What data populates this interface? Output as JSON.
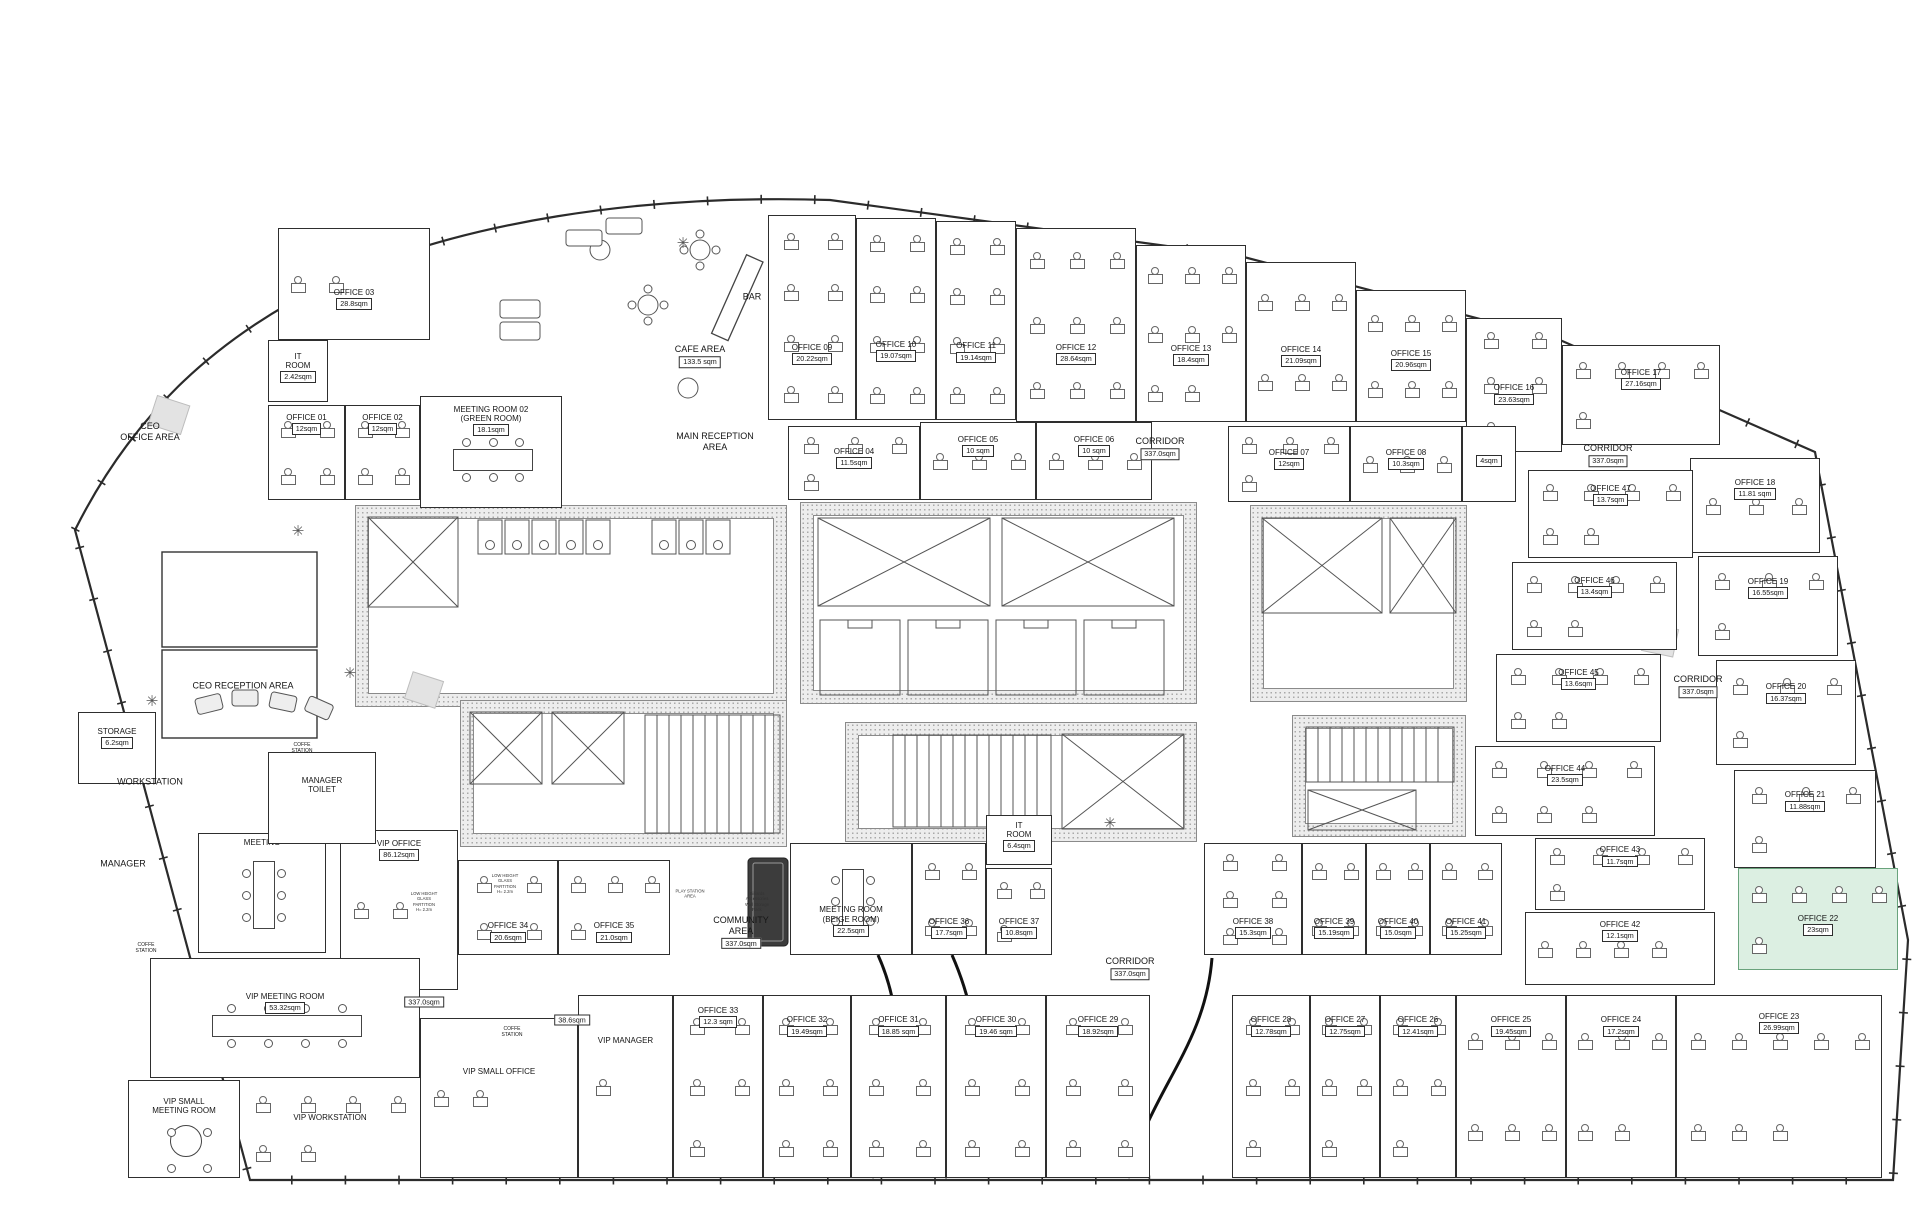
{
  "floorplan": {
    "corridor_text": "CORRIDOR",
    "corridor_area": "337.0sqm",
    "highlight_color": "#dcefe2",
    "rooms": [
      {
        "n": "OFFICE 03",
        "a": "28.8sqm",
        "r": [
          278,
          228,
          152,
          112
        ],
        "d": 2,
        "f": 0.6
      },
      {
        "n": "IT\nROOM",
        "a": "2.42sqm",
        "r": [
          268,
          340,
          60,
          62
        ],
        "f": 0.3
      },
      {
        "n": "OFFICE 01",
        "a": "12sqm",
        "r": [
          268,
          405,
          77,
          95
        ],
        "d": 4,
        "f": 0.16
      },
      {
        "n": "OFFICE 02",
        "a": "12sqm",
        "r": [
          345,
          405,
          75,
          95
        ],
        "d": 4,
        "f": 0.16
      },
      {
        "n": "MEETING ROOM 02\n(GREEN ROOM)",
        "a": "18.1sqm",
        "r": [
          420,
          396,
          142,
          112
        ],
        "t": "h",
        "f": 0.14
      },
      {
        "n": "OFFICE 09",
        "a": "20.22sqm",
        "r": [
          768,
          215,
          88,
          205
        ],
        "d": 8,
        "f": 0.66
      },
      {
        "n": "OFFICE 10",
        "a": "19.07sqm",
        "r": [
          856,
          218,
          80,
          202
        ],
        "d": 8,
        "f": 0.64
      },
      {
        "n": "OFFICE 11",
        "a": "19.14sqm",
        "r": [
          936,
          221,
          80,
          199
        ],
        "d": 8,
        "f": 0.64
      },
      {
        "n": "OFFICE 12",
        "a": "28.64sqm",
        "r": [
          1016,
          228,
          120,
          194
        ],
        "d": 9,
        "f": 0.63
      },
      {
        "n": "OFFICE 13",
        "a": "18.4sqm",
        "r": [
          1136,
          245,
          110,
          177
        ],
        "d": 8,
        "f": 0.6
      },
      {
        "n": "OFFICE 14",
        "a": "21.09sqm",
        "r": [
          1246,
          262,
          110,
          160
        ],
        "d": 6,
        "f": 0.56
      },
      {
        "n": "OFFICE 15",
        "a": "20.96sqm",
        "r": [
          1356,
          290,
          110,
          132
        ],
        "d": 6,
        "f": 0.5
      },
      {
        "n": "OFFICE 16",
        "a": "23.63sqm",
        "r": [
          1466,
          318,
          96,
          134
        ],
        "d": 5,
        "f": 0.54
      },
      {
        "n": "OFFICE 17",
        "a": "27.16sqm",
        "r": [
          1562,
          345,
          158,
          100
        ],
        "d": 5,
        "f": 0.3
      },
      {
        "n": "OFFICE 04",
        "a": "11.5sqm",
        "r": [
          788,
          426,
          132,
          74
        ],
        "d": 4,
        "f": 0.38
      },
      {
        "n": "OFFICE 05",
        "a": "10 sqm",
        "r": [
          920,
          422,
          116,
          78
        ],
        "d": 3,
        "f": 0.26
      },
      {
        "n": "OFFICE 06",
        "a": "10 sqm",
        "r": [
          1036,
          422,
          116,
          78
        ],
        "d": 3,
        "f": 0.26
      },
      {
        "n": "OFFICE 07",
        "a": "12sqm",
        "r": [
          1228,
          426,
          122,
          76
        ],
        "d": 4,
        "f": 0.38
      },
      {
        "n": "OFFICE 08",
        "a": "10.3sqm",
        "r": [
          1350,
          426,
          112,
          76
        ],
        "d": 3,
        "f": 0.38
      },
      {
        "n": "",
        "a": "4sqm",
        "r": [
          1462,
          426,
          54,
          76
        ],
        "f": 0.34
      },
      {
        "n": "OFFICE 18",
        "a": "11.81 sqm",
        "r": [
          1690,
          458,
          130,
          95
        ],
        "d": 3,
        "f": 0.28
      },
      {
        "n": "OFFICE 19",
        "a": "16.55sqm",
        "r": [
          1698,
          556,
          140,
          100
        ],
        "d": 4,
        "f": 0.28
      },
      {
        "n": "OFFICE 20",
        "a": "16.37sqm",
        "r": [
          1716,
          660,
          140,
          105
        ],
        "d": 4,
        "f": 0.28
      },
      {
        "n": "OFFICE 21",
        "a": "11.88sqm",
        "r": [
          1734,
          770,
          142,
          98
        ],
        "d": 4,
        "f": 0.28
      },
      {
        "n": "OFFICE 22",
        "a": "23sqm",
        "r": [
          1738,
          868,
          160,
          102
        ],
        "d": 5,
        "f": 0.52,
        "bg": "green"
      },
      {
        "n": "OFFICE 47",
        "a": "13.7sqm",
        "r": [
          1528,
          470,
          165,
          88
        ],
        "d": 6,
        "f": 0.24
      },
      {
        "n": "OFFICE 46",
        "a": "13.4sqm",
        "r": [
          1512,
          562,
          165,
          88
        ],
        "d": 6,
        "f": 0.24
      },
      {
        "n": "OFFICE 45",
        "a": "13.6sqm",
        "r": [
          1496,
          654,
          165,
          88
        ],
        "d": 6,
        "f": 0.24
      },
      {
        "n": "OFFICE 44",
        "a": "23.5sqm",
        "r": [
          1475,
          746,
          180,
          90
        ],
        "d": 7,
        "f": 0.28
      },
      {
        "n": "OFFICE 43",
        "a": "11.7sqm",
        "r": [
          1535,
          838,
          170,
          72
        ],
        "d": 5,
        "f": 0.2
      },
      {
        "n": "OFFICE 42",
        "a": "12.1sqm",
        "r": [
          1525,
          912,
          190,
          73
        ],
        "d": 4,
        "f": 0.2
      },
      {
        "n": "VIP OFFICE",
        "a": "86.12sqm",
        "r": [
          340,
          830,
          118,
          160
        ],
        "d": 2,
        "f": 0.1
      },
      {
        "n": "OFFICE 34",
        "a": "20.6sqm",
        "r": [
          458,
          860,
          100,
          95
        ],
        "d": 4,
        "f": 0.72
      },
      {
        "n": "OFFICE 35",
        "a": "21.0sqm",
        "r": [
          558,
          860,
          112,
          95
        ],
        "d": 4,
        "f": 0.72
      },
      {
        "n": "MEETING ROOM\n(BEIGE ROOM)",
        "a": "22.5sqm",
        "r": [
          790,
          843,
          122,
          112
        ],
        "t": "v",
        "f": 0.62
      },
      {
        "n": "OFFICE 36",
        "a": "17.7sqm",
        "r": [
          912,
          843,
          74,
          112
        ],
        "d": 4,
        "f": 0.72
      },
      {
        "n": "IT\nROOM",
        "a": "6.4sqm",
        "r": [
          986,
          815,
          66,
          50
        ],
        "f": 0.26
      },
      {
        "n": "OFFICE 37",
        "a": "10.8sqm",
        "r": [
          986,
          868,
          66,
          87
        ],
        "d": 3,
        "f": 0.64
      },
      {
        "n": "OFFICE 38",
        "a": "15.3sqm",
        "r": [
          1204,
          843,
          98,
          112
        ],
        "d": 6,
        "f": 0.72
      },
      {
        "n": "OFFICE 39",
        "a": "15.19sqm",
        "r": [
          1302,
          843,
          64,
          112
        ],
        "d": 4,
        "f": 0.72
      },
      {
        "n": "OFFICE 40",
        "a": "15.0sqm",
        "r": [
          1366,
          843,
          64,
          112
        ],
        "d": 4,
        "f": 0.72
      },
      {
        "n": "OFFICE 41",
        "a": "15.25sqm",
        "r": [
          1430,
          843,
          72,
          112
        ],
        "d": 4,
        "f": 0.72
      },
      {
        "n": "VIP MANAGER",
        "a": null,
        "r": [
          578,
          995,
          95,
          183
        ],
        "d": 1,
        "f": 0.26
      },
      {
        "n": "OFFICE 33",
        "a": "12.3 sqm",
        "r": [
          673,
          995,
          90,
          183
        ],
        "d": 5,
        "f": 0.1
      },
      {
        "n": "OFFICE 32",
        "a": "19.49sqm",
        "r": [
          763,
          995,
          88,
          183
        ],
        "d": 6,
        "f": 0.15
      },
      {
        "n": "OFFICE 31",
        "a": "18.85 sqm",
        "r": [
          851,
          995,
          95,
          183
        ],
        "d": 6,
        "f": 0.15
      },
      {
        "n": "OFFICE 30",
        "a": "19.46 sqm",
        "r": [
          946,
          995,
          100,
          183
        ],
        "d": 6,
        "f": 0.15
      },
      {
        "n": "OFFICE 29",
        "a": "18.92sqm",
        "r": [
          1046,
          995,
          104,
          183
        ],
        "d": 6,
        "f": 0.15
      },
      {
        "n": "OFFICE 28",
        "a": "12.78sqm",
        "r": [
          1232,
          995,
          78,
          183
        ],
        "d": 5,
        "f": 0.15
      },
      {
        "n": "OFFICE 27",
        "a": "12.75sqm",
        "r": [
          1310,
          995,
          70,
          183
        ],
        "d": 5,
        "f": 0.15
      },
      {
        "n": "OFFICE 26",
        "a": "12.41sqm",
        "r": [
          1380,
          995,
          76,
          183
        ],
        "d": 5,
        "f": 0.15
      },
      {
        "n": "OFFICE 25",
        "a": "19.45sqm",
        "r": [
          1456,
          995,
          110,
          183
        ],
        "d": 6,
        "f": 0.15
      },
      {
        "n": "OFFICE 24",
        "a": "17.2sqm",
        "r": [
          1566,
          995,
          110,
          183
        ],
        "d": 5,
        "f": 0.15
      },
      {
        "n": "OFFICE 23",
        "a": "26.99sqm",
        "r": [
          1676,
          995,
          206,
          183
        ],
        "d": 8,
        "f": 0.13
      },
      {
        "n": "VIP SMALL OFFICE",
        "a": null,
        "r": [
          420,
          1018,
          158,
          160
        ],
        "d": 2,
        "f": 0.35
      },
      {
        "n": "VIP MEETING ROOM",
        "a": "53.32sqm",
        "r": [
          150,
          958,
          270,
          120
        ],
        "t": "h",
        "f": 0.34
      },
      {
        "n": "VIP SMALL\nMEETING ROOM",
        "a": null,
        "r": [
          128,
          1080,
          112,
          98
        ],
        "t": "round",
        "f": 0.24
      },
      {
        "n": "VIP WORKSTATION",
        "a": null,
        "r": [
          240,
          1080,
          180,
          98
        ],
        "d": 6,
        "f": 0.42,
        "open": true
      },
      {
        "n": "MEETING",
        "a": null,
        "r": [
          198,
          833,
          128,
          120
        ],
        "t": "v",
        "f": 0.1
      },
      {
        "n": "MANAGER\nTOILET",
        "a": null,
        "r": [
          268,
          752,
          108,
          92
        ],
        "f": 0.34
      },
      {
        "n": "STORAGE",
        "a": "6.2sqm",
        "r": [
          78,
          712,
          78,
          72
        ],
        "f": 0.3
      }
    ],
    "labels": [
      {
        "t": "CEO\nOFFICE AREA",
        "x": 150,
        "y": 432
      },
      {
        "t": "CEO  RECEPTION AREA",
        "x": 243,
        "y": 686
      },
      {
        "t": "MAIN RECEPTION\nAREA",
        "x": 715,
        "y": 442
      },
      {
        "t": "CAFE AREA",
        "a": "133.5 sqm",
        "x": 700,
        "y": 356
      },
      {
        "t": "BAR",
        "x": 752,
        "y": 297
      },
      {
        "t": "COMMUNITY\nAREA",
        "a": "337.0sqm",
        "x": 741,
        "y": 932
      },
      {
        "t": "WORKSTATION",
        "x": 150,
        "y": 782
      },
      {
        "t": "MANAGER",
        "x": 123,
        "y": 864
      },
      {
        "t": "PLAY STATION\nAREA",
        "x": 690,
        "y": 894,
        "cls": "micro"
      },
      {
        "t": "COFFE\nSTATION",
        "x": 302,
        "y": 748,
        "cls": "tiny"
      },
      {
        "t": "COFFE\nSTATION",
        "x": 512,
        "y": 1032,
        "cls": "tiny"
      },
      {
        "t": "COFFE\nSTATION",
        "x": 146,
        "y": 948,
        "cls": "tiny"
      },
      {
        "t": "LOW HEIGHT\nGLASS\nPARTITION\nH= 2.2m",
        "x": 424,
        "y": 902,
        "cls": "micro"
      },
      {
        "t": "LOW HEIGHT\nGLASS\nPARTITION\nH= 2.2m",
        "x": 505,
        "y": 884,
        "cls": "micro"
      },
      {
        "t": "Billiards\nAccessories\nWall Storage\nRack",
        "x": 757,
        "y": 902,
        "cls": "micro"
      }
    ],
    "corridors": [
      {
        "x": 1160,
        "y": 448
      },
      {
        "x": 1608,
        "y": 455
      },
      {
        "x": 1698,
        "y": 686
      },
      {
        "x": 1130,
        "y": 968
      }
    ],
    "boxes": [
      {
        "t": "337.0sqm",
        "x": 424,
        "y": 1002
      },
      {
        "t": "38.6sqm",
        "x": 572,
        "y": 1020
      }
    ]
  }
}
